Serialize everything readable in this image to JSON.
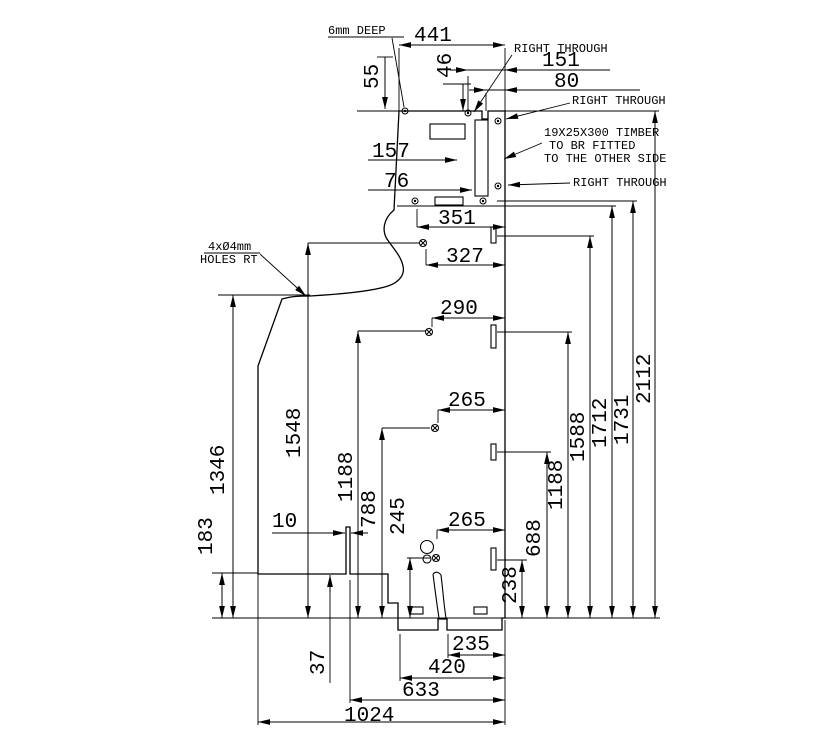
{
  "drawing": {
    "annotations": {
      "deep_note": "6mm DEEP",
      "right_through_top": "RIGHT THROUGH",
      "right_through_mid": "RIGHT THROUGH",
      "right_through_bottom": "RIGHT THROUGH",
      "timber_line1": "19X25X300 TIMBER",
      "timber_line2": "TO BR FITTED",
      "timber_line3": "TO THE OTHER SIDE",
      "holes_line1": "4xØ4mm",
      "holes_line2": "HOLES RT"
    },
    "dimensions": {
      "d441": "441",
      "d55": "55",
      "d46": "46",
      "d151": "151",
      "d80": "80",
      "d157": "157",
      "d76": "76",
      "d351": "351",
      "d327": "327",
      "d290": "290",
      "d265_upper": "265",
      "d265_lower": "265",
      "d245": "245",
      "d1346": "1346",
      "d183": "183",
      "d1548": "1548",
      "d1188_left": "1188",
      "d788": "788",
      "d10": "10",
      "d37": "37",
      "d238": "238",
      "d688": "688",
      "d1188_right": "1188",
      "d1588": "1588",
      "d1712": "1712",
      "d1731": "1731",
      "d2112": "2112",
      "d235": "235",
      "d420": "420",
      "d633": "633",
      "d1024": "1024"
    }
  }
}
